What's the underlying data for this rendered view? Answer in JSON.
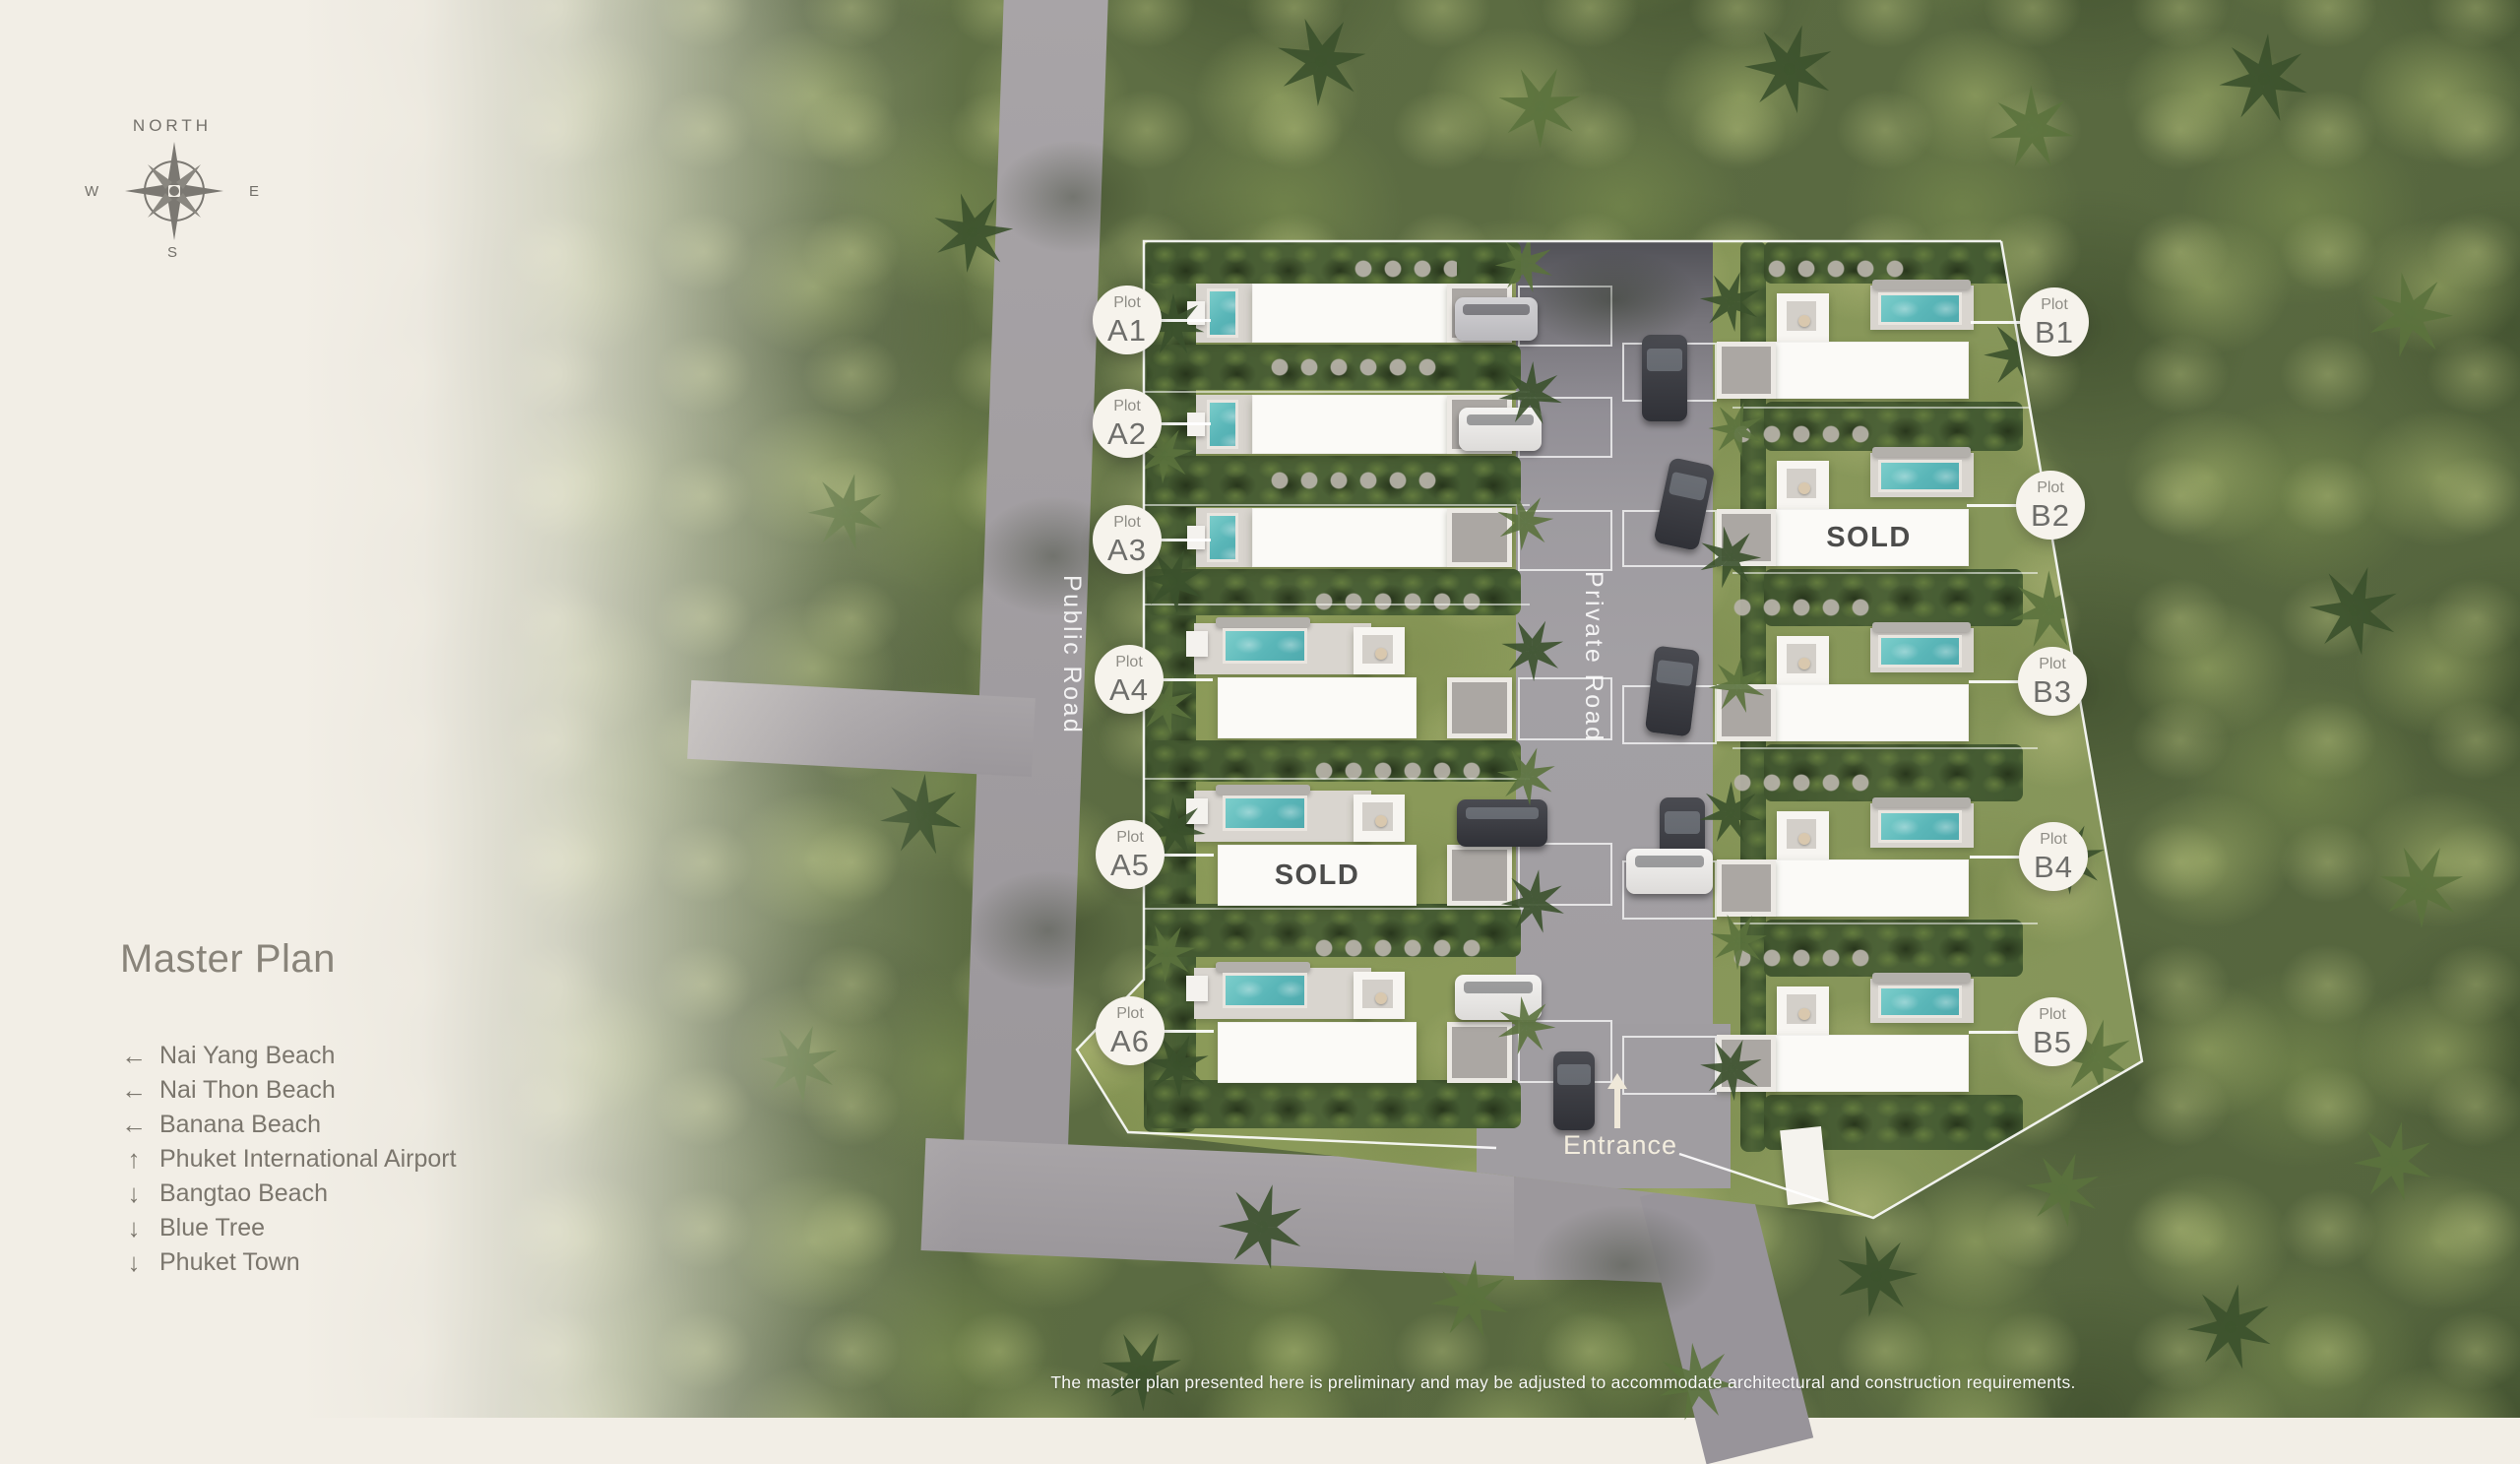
{
  "compass": {
    "north": "NORTH",
    "west": "W",
    "east": "E",
    "south": "S"
  },
  "panel": {
    "title": "Master Plan",
    "locations": [
      {
        "arrow": "←",
        "label": "Nai Yang Beach"
      },
      {
        "arrow": "←",
        "label": "Nai Thon Beach"
      },
      {
        "arrow": "←",
        "label": "Banana Beach"
      },
      {
        "arrow": "↑",
        "label": "Phuket International Airport"
      },
      {
        "arrow": "↓",
        "label": "Bangtao Beach"
      },
      {
        "arrow": "↓",
        "label": "Blue Tree"
      },
      {
        "arrow": "↓",
        "label": "Phuket Town"
      }
    ]
  },
  "labels": {
    "plot": "Plot",
    "sold": "SOLD",
    "entrance": "Entrance",
    "public_road": "Public Road",
    "private_road": "Private Road"
  },
  "plots": [
    {
      "id": "A1",
      "sold": false
    },
    {
      "id": "A2",
      "sold": false
    },
    {
      "id": "A3",
      "sold": false
    },
    {
      "id": "A4",
      "sold": false
    },
    {
      "id": "A5",
      "sold": true
    },
    {
      "id": "A6",
      "sold": false
    },
    {
      "id": "B1",
      "sold": false
    },
    {
      "id": "B2",
      "sold": true
    },
    {
      "id": "B3",
      "sold": false
    },
    {
      "id": "B4",
      "sold": false
    },
    {
      "id": "B5",
      "sold": false
    }
  ],
  "disclaimer": "The master plan presented here is preliminary and may be adjusted to accommodate architectural and construction requirements.",
  "colors": {
    "cream": "#f2eee6",
    "text_gray": "#7b766d",
    "road": "#9c989c",
    "pool": "#5ab6b8",
    "lawn": "#8c9b59",
    "forest": "#5d6d43",
    "villa_white": "#fbfaf7",
    "sold_text": "#4c4c4b"
  }
}
